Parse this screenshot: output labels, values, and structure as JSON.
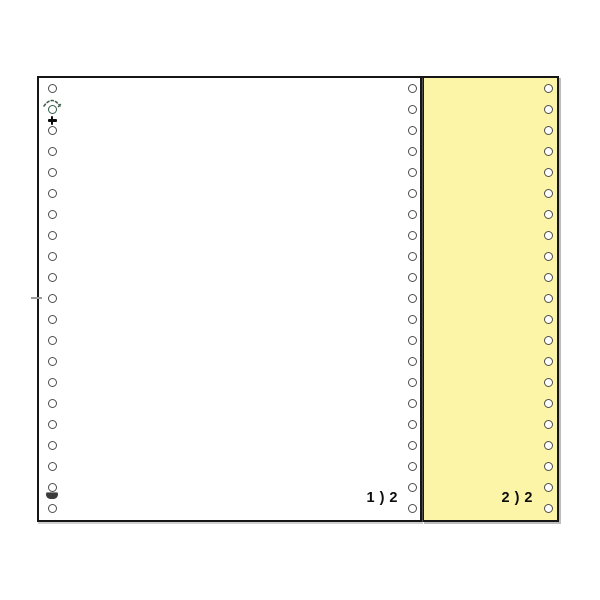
{
  "image": {
    "subject": "two-ply continuous tractor-feed listing paper",
    "background": "#ffffff"
  },
  "colors": {
    "white_ply": "#ffffff",
    "yellow_ply": "#fcf5a8",
    "sheet_border": "#161616",
    "hole_outline": "#4d4d4d",
    "green_ring": "#2f5d46",
    "shadow": "#bdbdbd"
  },
  "plies": [
    {
      "name": "white-ply",
      "page_label": "1 ) 2"
    },
    {
      "name": "yellow-ply",
      "page_label": "2 ) 2"
    }
  ],
  "holes": {
    "per_column": 21,
    "columns": [
      {
        "container": "white-left-holes"
      },
      {
        "container": "white-right-holes"
      },
      {
        "container": "yellow-right-holes"
      }
    ]
  },
  "marks": {
    "sparkle": "radiating-dashes-over-second-hole",
    "plus": "+",
    "smudge": "dark-smudge-above-last-hole",
    "edge_tick": "gray-tick-on-left-edge"
  }
}
